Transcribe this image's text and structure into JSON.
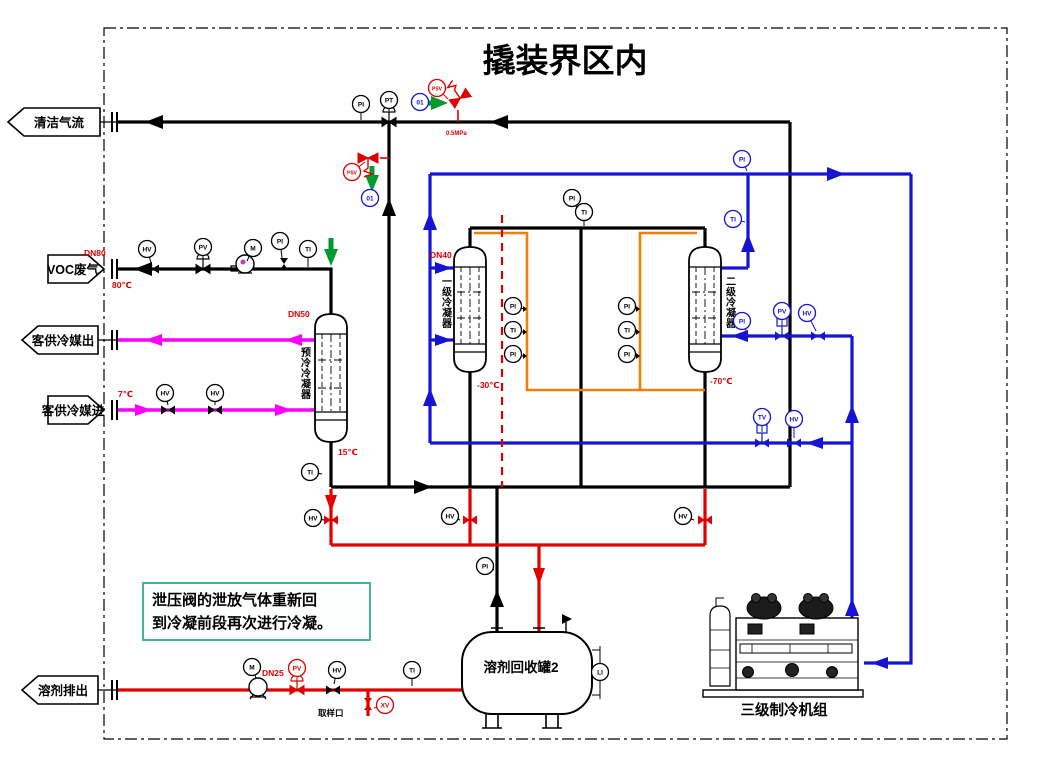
{
  "title": "撬装界区内",
  "boundary": {
    "clean_gas": "清洁气流",
    "voc_inlet": "VOC废气",
    "coolant_out": "客供冷媒出",
    "coolant_in": "客供冷媒进",
    "solvent_out": "溶剂排出"
  },
  "equipment": {
    "precooler": "预冷冷凝器",
    "condenser1": "一级冷凝器",
    "condenser2": "二级冷凝器",
    "tank": "溶剂回收罐2",
    "chiller": "三级制冷机组"
  },
  "note": {
    "line1": "泄压阀的泄放气体重新回",
    "line2": "到冷凝前段再次进行冷凝。"
  },
  "labels": {
    "dn80": "DN80",
    "t80": "80℃",
    "t7": "7℃",
    "dn50": "DN50",
    "t15": "15℃",
    "dn40": "DN40",
    "t30": "-30℃",
    "t70": "-70℃",
    "dn25": "DN25",
    "relief_set": "0.5MPa",
    "sample_port": "取样口"
  },
  "colors": {
    "gas": "#000000",
    "solvent": "#e00000",
    "refrigerant": "#1414d2",
    "coolant": "#ff00ff",
    "defrost": "#f08000",
    "relief_arrow": "#009a30",
    "note_text": "#008a35",
    "note_border": "#49b489"
  },
  "instruments": [
    {
      "x": 361,
      "y": 104,
      "label": "PI",
      "color": "black",
      "sx": 361,
      "sy": 120
    },
    {
      "x": 389,
      "y": 100,
      "label": "PT",
      "color": "black",
      "sx": 389,
      "sy": 111
    },
    {
      "x": 147,
      "y": 249,
      "label": "HV",
      "color": "black",
      "sx": 152,
      "sy": 266
    },
    {
      "x": 203,
      "y": 247,
      "label": "PV",
      "color": "black",
      "sx": 203,
      "sy": 259
    },
    {
      "x": 253,
      "y": 248,
      "label": "M",
      "color": "black",
      "sx": 247,
      "sy": 261
    },
    {
      "x": 280,
      "y": 241,
      "label": "PI",
      "color": "black",
      "sx": 282,
      "sy": 258
    },
    {
      "x": 308,
      "y": 249,
      "label": "TI",
      "color": "black",
      "sx": 308,
      "sy": 267
    },
    {
      "x": 572,
      "y": 198,
      "label": "PI",
      "color": "black",
      "sx": 578,
      "sy": 210
    },
    {
      "x": 584,
      "y": 212,
      "label": "TI",
      "color": "black",
      "sx": 584,
      "sy": 226
    },
    {
      "x": 310,
      "y": 472,
      "label": "TI",
      "color": "black",
      "sx": 322,
      "sy": 474
    },
    {
      "x": 485,
      "y": 566,
      "label": "PI",
      "color": "black",
      "sx": 494,
      "sy": 570
    },
    {
      "x": 313,
      "y": 518,
      "label": "HV",
      "color": "black",
      "sx": 324,
      "sy": 520
    },
    {
      "x": 450,
      "y": 516,
      "label": "HV",
      "color": "black",
      "sx": 460,
      "sy": 520
    },
    {
      "x": 683,
      "y": 516,
      "label": "HV",
      "color": "black",
      "sx": 694,
      "sy": 520
    },
    {
      "x": 337,
      "y": 670,
      "label": "HV",
      "color": "black",
      "sx": 334,
      "sy": 684
    },
    {
      "x": 412,
      "y": 670,
      "label": "TI",
      "color": "black",
      "sx": 412,
      "sy": 686
    },
    {
      "x": 600,
      "y": 672,
      "label": "LI",
      "color": "black"
    },
    {
      "x": 165,
      "y": 393,
      "label": "HV",
      "color": "black",
      "sx": 168,
      "sy": 405
    },
    {
      "x": 215,
      "y": 393,
      "label": "HV",
      "color": "black",
      "sx": 215,
      "sy": 405
    },
    {
      "x": 513,
      "y": 306,
      "label": "PI",
      "color": "black",
      "sx": 524,
      "sy": 309
    },
    {
      "x": 513,
      "y": 330,
      "label": "TI",
      "color": "black",
      "sx": 524,
      "sy": 332
    },
    {
      "x": 513,
      "y": 354,
      "label": "PI",
      "color": "black",
      "sx": 524,
      "sy": 356
    },
    {
      "x": 627,
      "y": 306,
      "label": "PI",
      "color": "black",
      "sx": 637,
      "sy": 309
    },
    {
      "x": 627,
      "y": 330,
      "label": "TI",
      "color": "black",
      "sx": 637,
      "sy": 332
    },
    {
      "x": 627,
      "y": 354,
      "label": "PI",
      "color": "black",
      "sx": 637,
      "sy": 356
    },
    {
      "x": 742,
      "y": 159,
      "label": "PI",
      "color": "blue",
      "sx": 747,
      "sy": 171
    },
    {
      "x": 733,
      "y": 219,
      "label": "TI",
      "color": "blue",
      "sx": 745,
      "sy": 222
    },
    {
      "x": 742,
      "y": 321,
      "label": "PI",
      "color": "blue",
      "sx": 747,
      "sy": 333
    },
    {
      "x": 782,
      "y": 311,
      "label": "PV",
      "color": "blue",
      "sx": 782,
      "sy": 326
    },
    {
      "x": 807,
      "y": 313,
      "label": "HV",
      "color": "blue",
      "sx": 816,
      "sy": 331
    },
    {
      "x": 762,
      "y": 417,
      "label": "TV",
      "color": "blue",
      "sx": 762,
      "sy": 432
    },
    {
      "x": 794,
      "y": 419,
      "label": "HV",
      "color": "blue",
      "sx": 794,
      "sy": 438
    },
    {
      "x": 420,
      "y": 102,
      "label": "01",
      "color": "blue"
    },
    {
      "x": 370,
      "y": 198,
      "label": "01",
      "color": "blue"
    },
    {
      "x": 437,
      "y": 88,
      "label": "PSV",
      "color": "red",
      "sx": 448,
      "sy": 99
    },
    {
      "x": 352,
      "y": 172,
      "label": "PSV",
      "color": "red",
      "sx": 365,
      "sy": 162
    },
    {
      "x": 297,
      "y": 668,
      "label": "PV",
      "color": "red",
      "sx": 297,
      "sy": 682
    },
    {
      "x": 385,
      "y": 705,
      "label": "XV",
      "color": "red",
      "sx": 374,
      "sy": 708
    },
    {
      "x": 252,
      "y": 667,
      "label": "M",
      "color": "black",
      "sx": 256,
      "sy": 678
    }
  ]
}
